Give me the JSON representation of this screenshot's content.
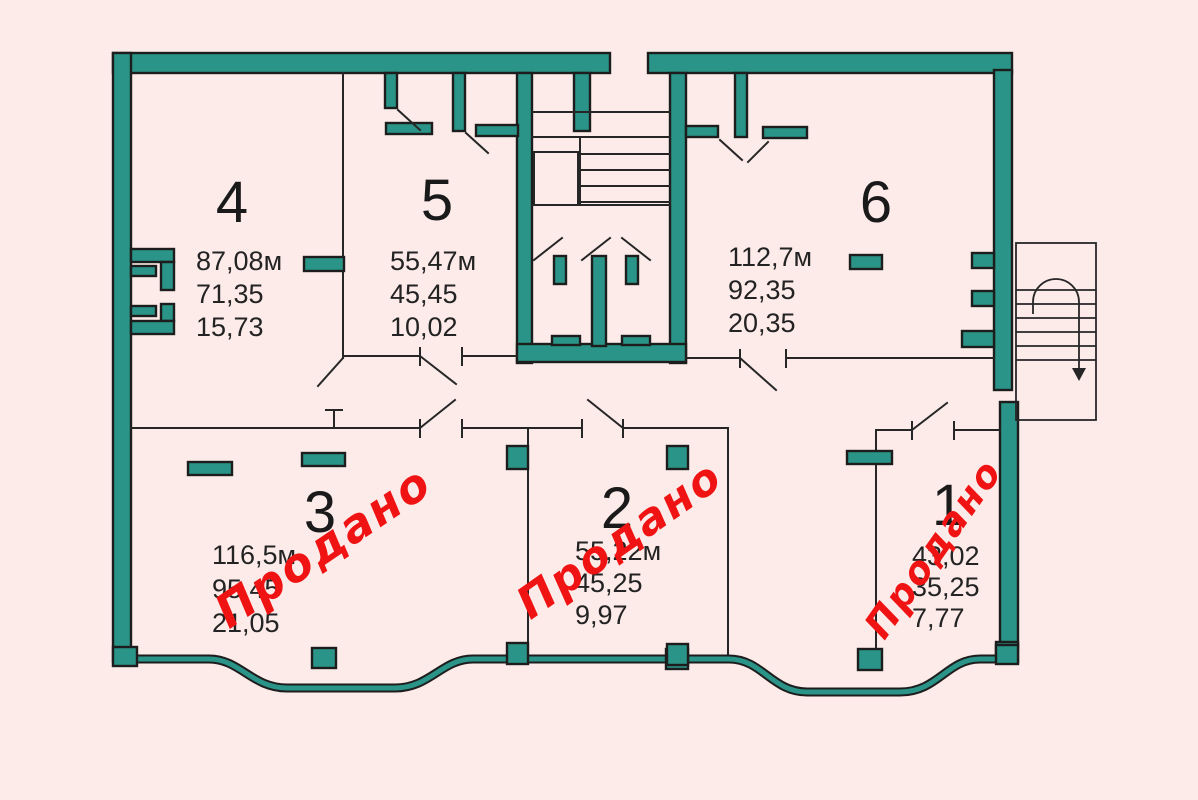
{
  "plan": {
    "title": "floor-plan",
    "units": [
      {
        "number": "4",
        "area_total": "87,08м",
        "area_living": "71,35",
        "area_kitchen": "15,73",
        "sold": false
      },
      {
        "number": "5",
        "area_total": "55,47м",
        "area_living": "45,45",
        "area_kitchen": "10,02",
        "sold": false
      },
      {
        "number": "6",
        "area_total": "112,7м",
        "area_living": "92,35",
        "area_kitchen": "20,35",
        "sold": false
      },
      {
        "number": "3",
        "area_total": "116,5м",
        "area_living": "95,45",
        "area_kitchen": "21,05",
        "sold": true,
        "sold_label": "Продано"
      },
      {
        "number": "2",
        "area_total": "55,22м",
        "area_living": "45,25",
        "area_kitchen": "9,97",
        "sold": true,
        "sold_label": "Продано"
      },
      {
        "number": "1",
        "area_total": "43,02",
        "area_living": "35,25",
        "area_kitchen": "7,77",
        "sold": true,
        "sold_label": "Продано"
      }
    ],
    "colors": {
      "background": "#fcebe9",
      "wall": "#2a9488",
      "outline": "#1d1d1d",
      "stamp": "#f01313"
    }
  }
}
